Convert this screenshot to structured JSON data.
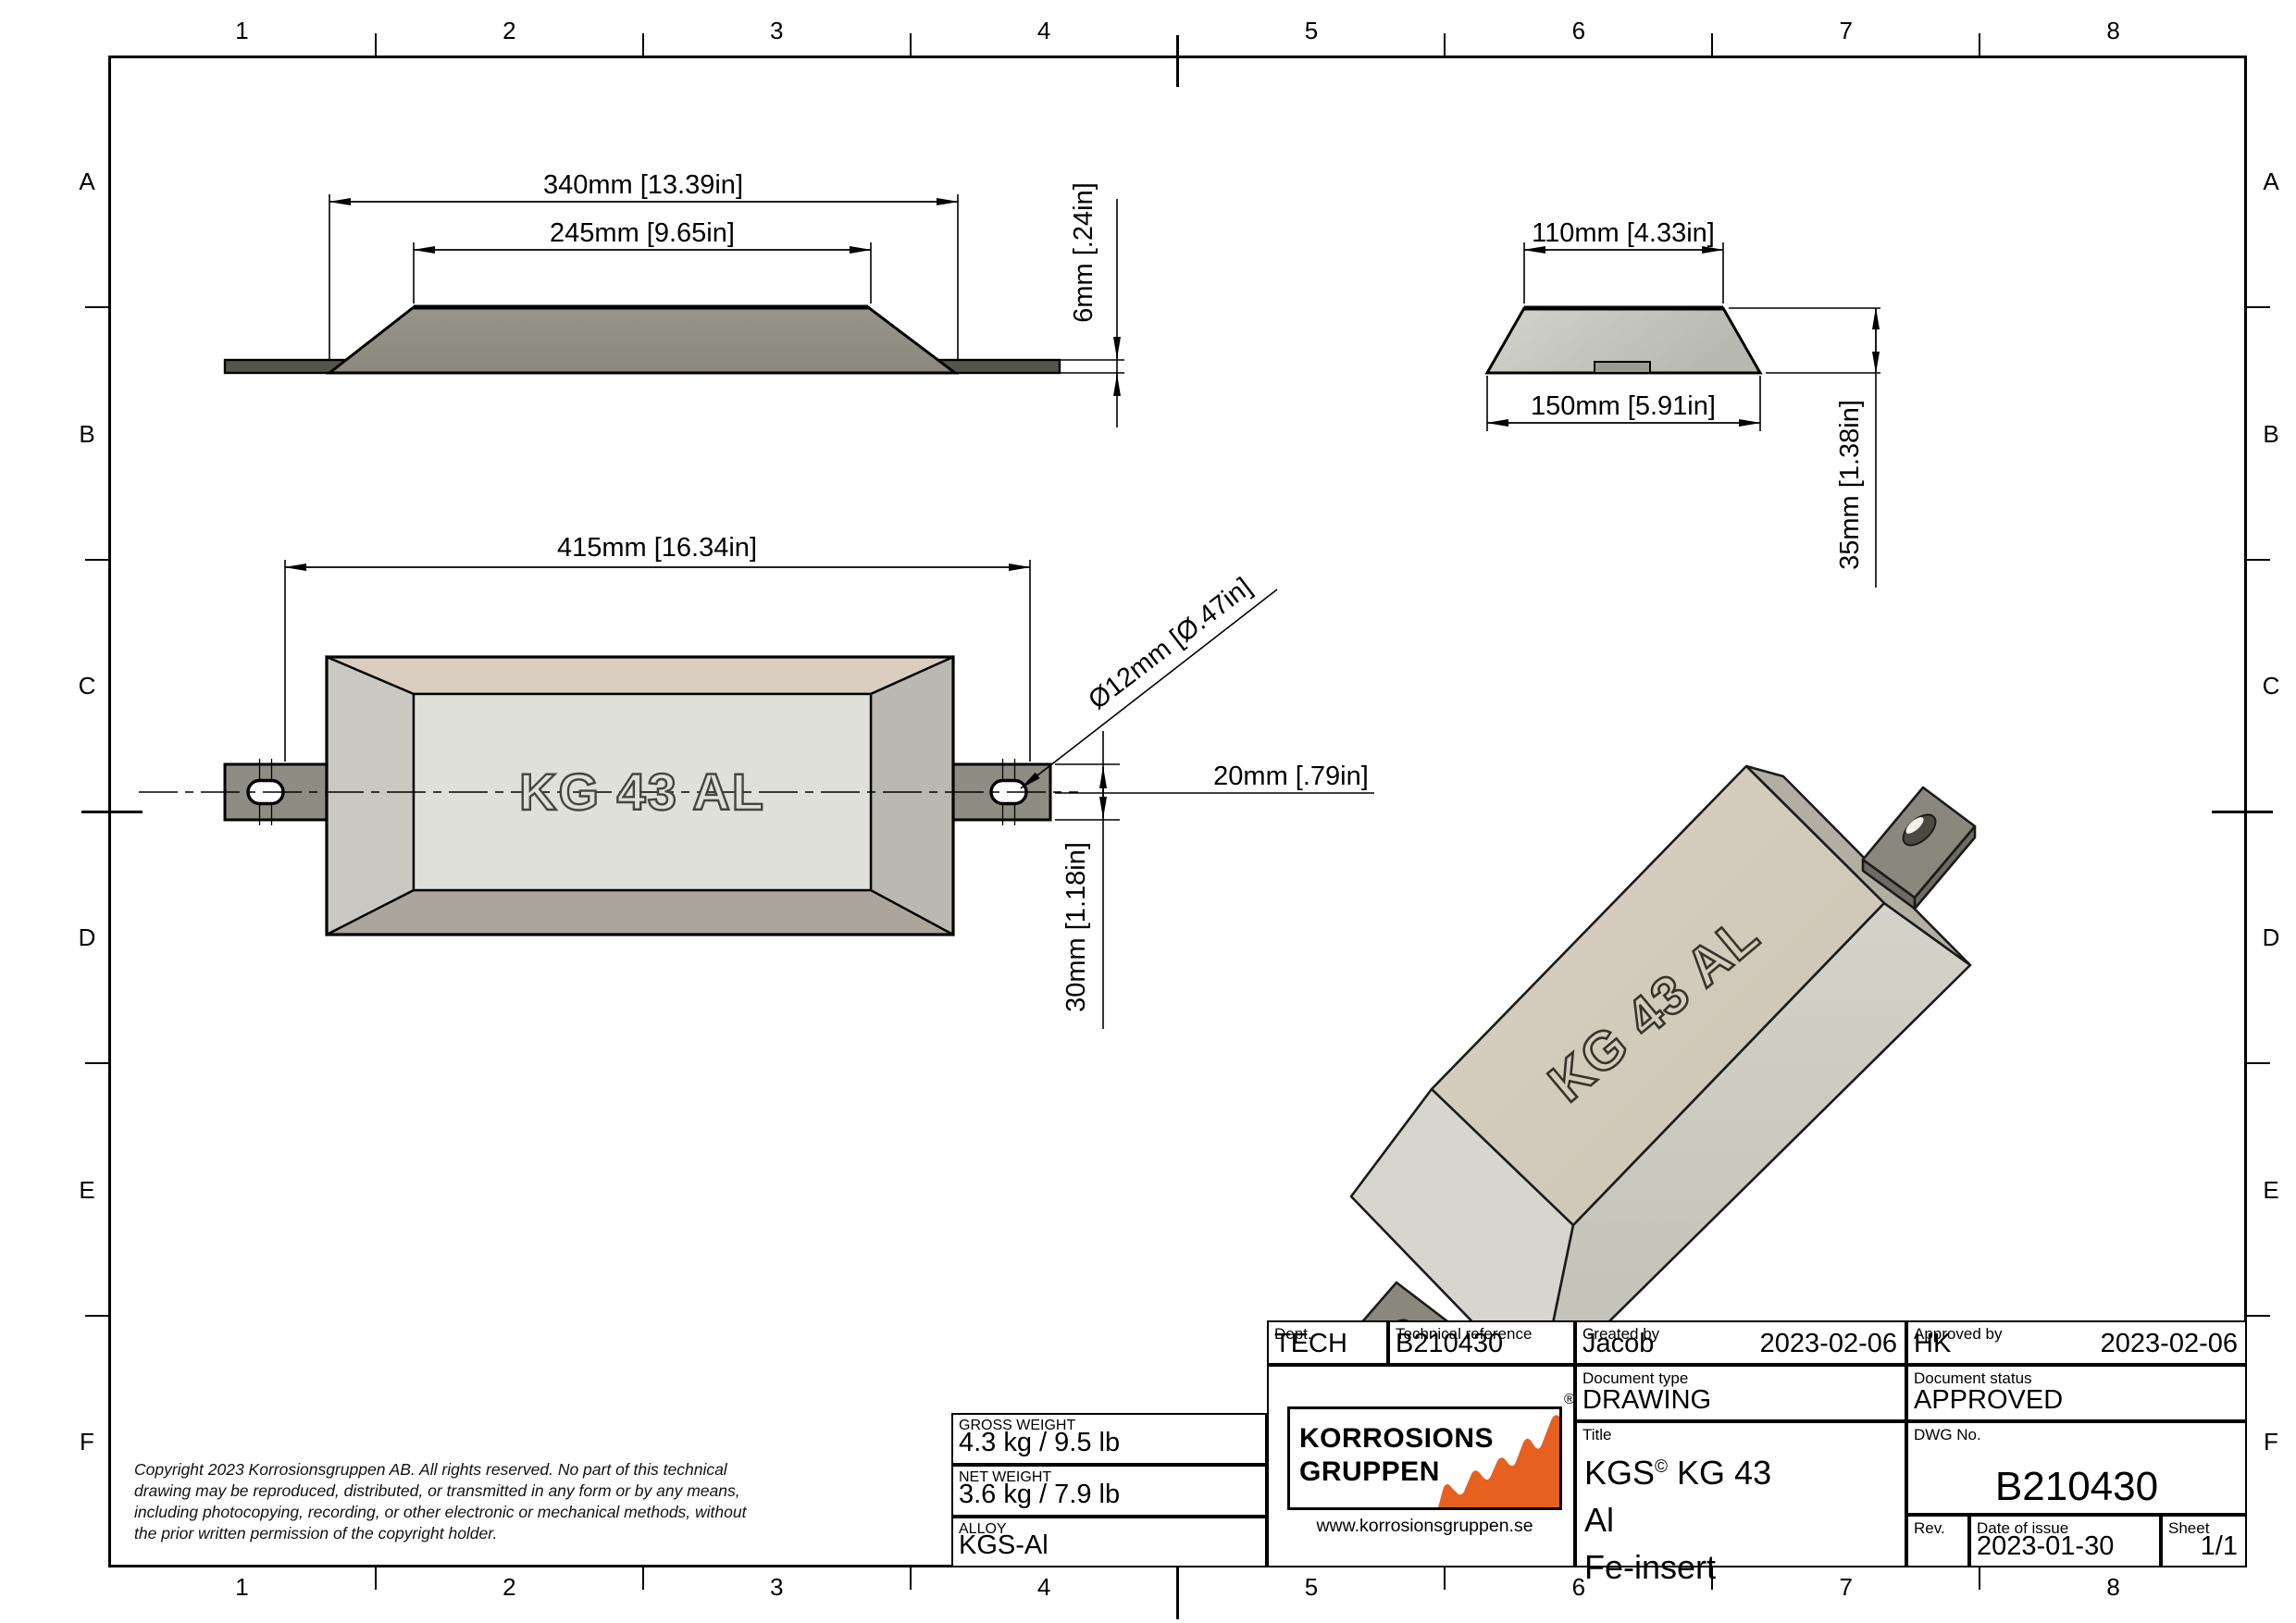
{
  "sheet": {
    "columns": [
      "1",
      "2",
      "3",
      "4",
      "5",
      "6",
      "7",
      "8"
    ],
    "rows": [
      "A",
      "B",
      "C",
      "D",
      "E",
      "F"
    ]
  },
  "views": {
    "side": {
      "dim_overall": "340mm [13.39in]",
      "dim_top": "245mm [9.65in]",
      "dim_strap_thickness": "6mm [.24in]"
    },
    "end": {
      "dim_top": "110mm [4.33in]",
      "dim_bottom": "150mm [5.91in]",
      "dim_height": "35mm [1.38in]"
    },
    "top": {
      "dim_overall": "415mm [16.34in]",
      "dim_hole": "Ø12mm [Ø.47in]",
      "dim_hole_offset": "20mm [.79in]",
      "dim_strap_width": "30mm [1.18in]",
      "emboss": "KG 43 AL"
    },
    "iso": {
      "emboss": "KG 43 AL"
    }
  },
  "title_block": {
    "dept": {
      "label": "Dept.",
      "value": "TECH"
    },
    "technical_reference": {
      "label": "Technical reference",
      "value": "B210430"
    },
    "created_by": {
      "label": "Created by",
      "name": "Jacob",
      "date": "2023-02-06"
    },
    "approved_by": {
      "label": "Approved by",
      "name": "HK",
      "date": "2023-02-06"
    },
    "document_type": {
      "label": "Document type",
      "value": "DRAWING"
    },
    "document_status": {
      "label": "Document status",
      "value": "APPROVED"
    },
    "title": {
      "label": "Title",
      "part1": "KGS",
      "sup": "©",
      "part2": " KG 43",
      "line2": "Al",
      "line3": "Fe-insert"
    },
    "dwg_no": {
      "label": "DWG No.",
      "value": "B210430"
    },
    "rev": {
      "label": "Rev.",
      "value": ""
    },
    "date_of_issue": {
      "label": "Date of issue",
      "value": "2023-01-30"
    },
    "sheet": {
      "label": "Sheet",
      "value": "1/1"
    }
  },
  "weights": {
    "gross": {
      "label": "GROSS WEIGHT",
      "value": "4.3 kg / 9.5 lb"
    },
    "net": {
      "label": "NET WEIGHT",
      "value": "3.6 kg / 7.9 lb"
    },
    "alloy": {
      "label": "ALLOY",
      "value": "KGS-Al"
    }
  },
  "logo": {
    "line1": "KORROSIONS",
    "line2": "GRUPPEN",
    "registered": "®",
    "url": "www.korrosionsgruppen.se"
  },
  "copyright": {
    "line1": "Copyright 2023 Korrosionsgruppen AB. All rights reserved. No part of this technical",
    "line2": "drawing may be reproduced, distributed, or transmitted in any form or by any means,",
    "line3": "including photocopying, recording, or other electronic or mechanical methods, without",
    "line4": "the prior written permission of the copyright holder."
  },
  "colors": {
    "accent": "#E6601F",
    "line": "#000000",
    "strap_dark": "#55544C",
    "strap_mid": "#8D8D84",
    "metal_mid": "#908E84",
    "metal_light": "#CBCDC6",
    "notch": "#9B9B93",
    "bevel_top": "#D9CDC0",
    "bevel_side_l": "#C9C9C1",
    "bevel_side_r": "#B9B9B1",
    "bevel_bottom": "#ABA59C",
    "face_inner": "#DFE0DA",
    "iso_top": "#D4CCBC",
    "iso_front": "#CACAC1",
    "iso_end_left": "#D6D6CE",
    "iso_end_right": "#B2AEA2",
    "iso_strap": "#8A887D",
    "iso_strap_edge": "#6E6C62",
    "hole_dark": "#4A4A40"
  }
}
